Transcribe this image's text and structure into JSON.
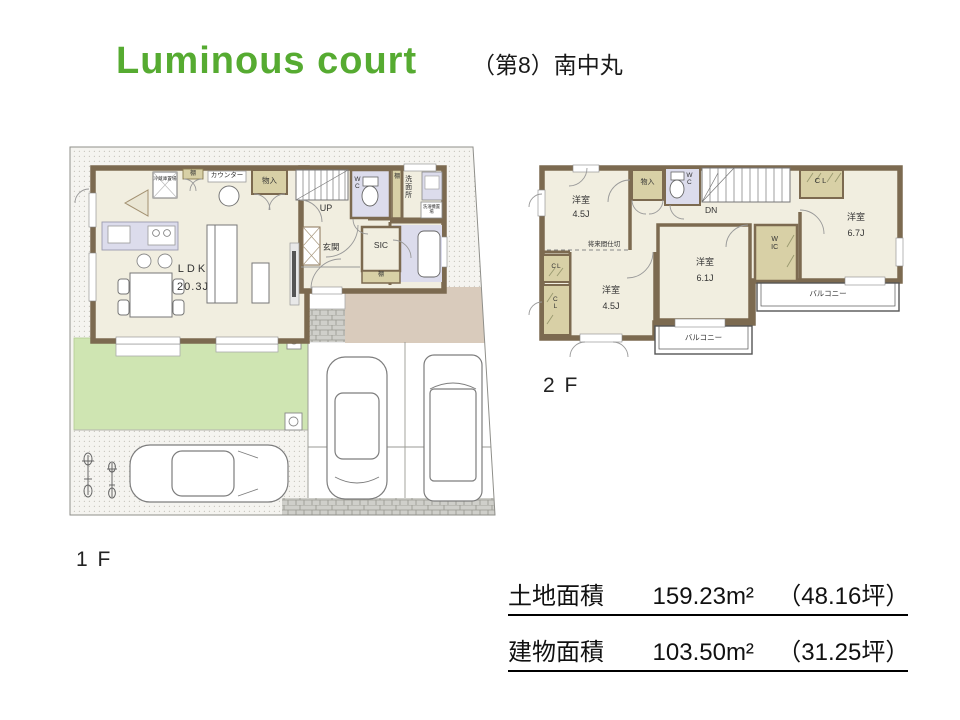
{
  "header": {
    "title": "Luminous court",
    "subtitle": "（第8）南中丸"
  },
  "floor1": {
    "label": "1 F",
    "ldk": {
      "name": "LDK",
      "size": "20.3J"
    },
    "counter": "カウンター",
    "shelf": "棚",
    "storage": "物入",
    "fridge": "冷蔵庫置場",
    "stairs_up": "UP",
    "wc": "WC",
    "washroom": "洗面所",
    "laundry": "洗濯機置場",
    "entrance": "玄関",
    "sic": "SIC"
  },
  "floor2": {
    "label": "2 F",
    "rooms": {
      "nw": {
        "name": "洋室",
        "size": "4.5J"
      },
      "sw": {
        "name": "洋室",
        "size": "4.5J"
      },
      "center": {
        "name": "洋室",
        "size": "6.1J"
      },
      "east": {
        "name": "洋室",
        "size": "6.7J"
      }
    },
    "storage": "物入",
    "wc": "WC",
    "stairs_down": "DN",
    "cl": "CL",
    "wic": "WIC",
    "balcony": "バルコニー",
    "future_partition": "将来間仕切"
  },
  "areas": {
    "land": {
      "label": "土地面積",
      "value": "159.23m²",
      "tsubo": "（48.16坪）"
    },
    "building": {
      "label": "建物面積",
      "value": "103.50m²",
      "tsubo": "（31.25坪）"
    }
  },
  "colors": {
    "title_green": "#56ab31",
    "wall_brown": "#7c6a50",
    "room_cream": "#f1eee0",
    "closet_olive": "#d8d0a6",
    "fixture_lavender": "#dcdcec",
    "lawn_green": "#cfe5b2",
    "driveway_tan": "#d9cbbc"
  }
}
